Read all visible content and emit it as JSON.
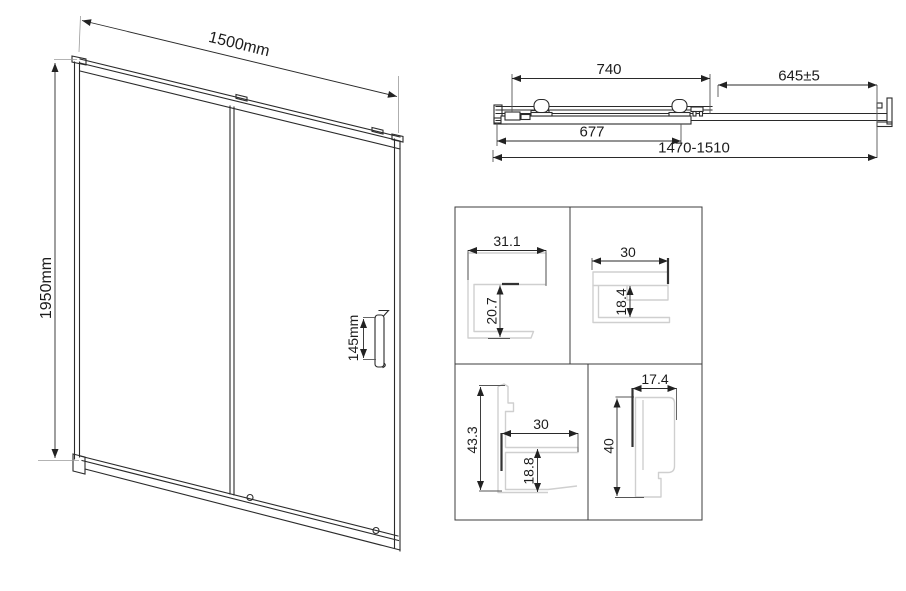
{
  "front_view": {
    "width": "1500mm",
    "height": "1950mm",
    "handle_height": "145mm"
  },
  "top_view": {
    "door_panel_width": "740",
    "fixed_panel_width": "645±5",
    "glass_width": "677",
    "adjustment_range": "1470-1510"
  },
  "profile_details": {
    "top_left": {
      "width": "31.1",
      "depth": "20.7"
    },
    "top_right": {
      "width": "30",
      "depth": "18.4"
    },
    "bottom_left": {
      "height": "43.3",
      "width": "30",
      "depth": "18.8"
    },
    "bottom_right": {
      "width": "17.4",
      "height": "40"
    }
  },
  "colors": {
    "line": "#2a2a2a",
    "profile_line": "#cfcfcf",
    "background": "#ffffff"
  }
}
